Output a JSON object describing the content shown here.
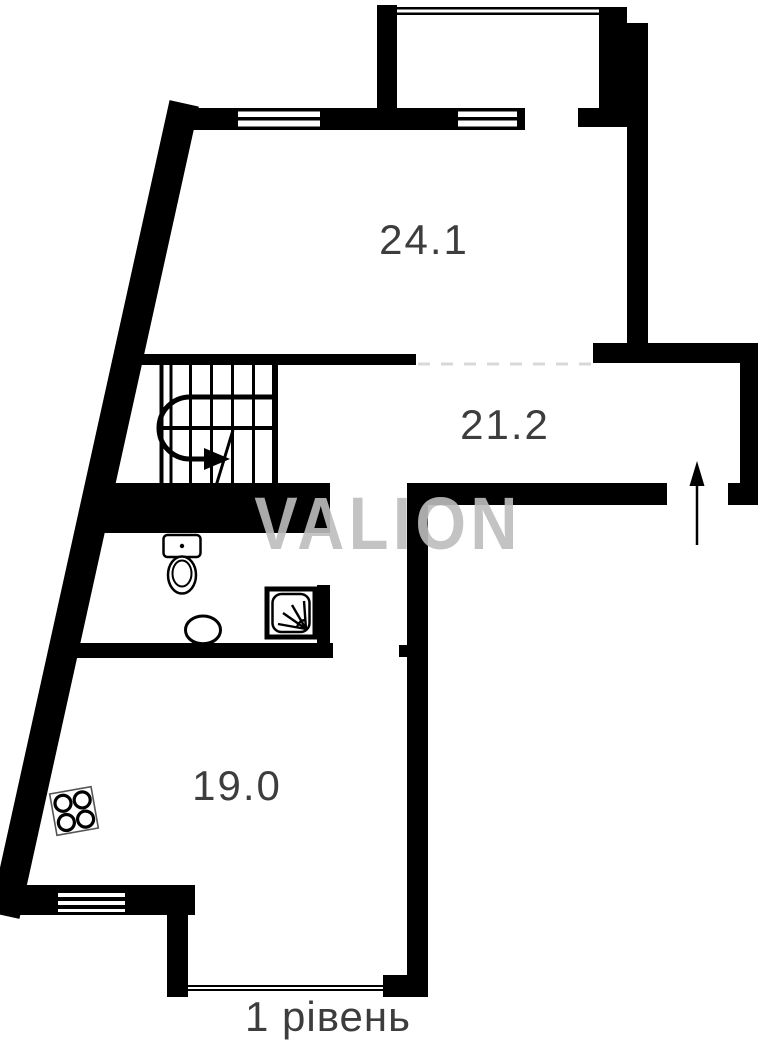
{
  "plan": {
    "type": "apartment-floor-plan",
    "caption": "1 рівень",
    "watermark": "VALION",
    "rooms": [
      {
        "id": "room-top",
        "area": "24.1"
      },
      {
        "id": "room-middle",
        "area": "21.2"
      },
      {
        "id": "room-bottom",
        "area": "19.0"
      }
    ],
    "icons": [
      "staircase-icon",
      "u-turn-arrow-icon",
      "entrance-arrow-icon",
      "toilet-icon",
      "sink-icon",
      "shower-icon",
      "stove-icon",
      "window-icon",
      "glazing-icon"
    ],
    "colors": {
      "wall": "#000000",
      "label": "#3d3d3d",
      "watermark": "#bdbdbd",
      "opening_dash": "#d8d8d8",
      "background": "#ffffff"
    }
  }
}
